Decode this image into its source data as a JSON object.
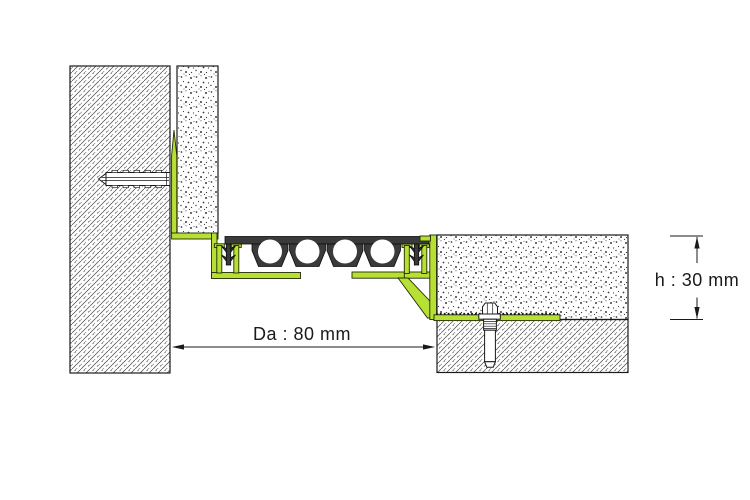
{
  "diagram": {
    "kind": "expansion-joint-profile-cross-section",
    "annotations": {
      "joint_width": {
        "symbol": "Da",
        "value": 80,
        "unit": "mm",
        "label": "Da : 80 mm"
      },
      "profile_height": {
        "symbol": "h",
        "value": 30,
        "unit": "mm",
        "label": "h : 30 mm"
      }
    },
    "colors": {
      "profile_green": "#b6e033",
      "rubber_dark": "#3a3a3a",
      "line": "#1a1a1a",
      "background": "#ffffff"
    },
    "parts": [
      {
        "name": "wall",
        "fill": "diagonal-hatch"
      },
      {
        "name": "wall-finish-layer",
        "fill": "stipple"
      },
      {
        "name": "wall-anchor-dowel",
        "fill": "white-outline"
      },
      {
        "name": "corner-profile-green",
        "fill": "green"
      },
      {
        "name": "rubber-expansion-insert",
        "fill": "dark",
        "holes": 4
      },
      {
        "name": "floor-profile-green",
        "fill": "green"
      },
      {
        "name": "floor-screed",
        "fill": "stipple"
      },
      {
        "name": "floor-slab",
        "fill": "diagonal-hatch"
      },
      {
        "name": "floor-anchor-bolt",
        "fill": "white-outline"
      }
    ]
  }
}
